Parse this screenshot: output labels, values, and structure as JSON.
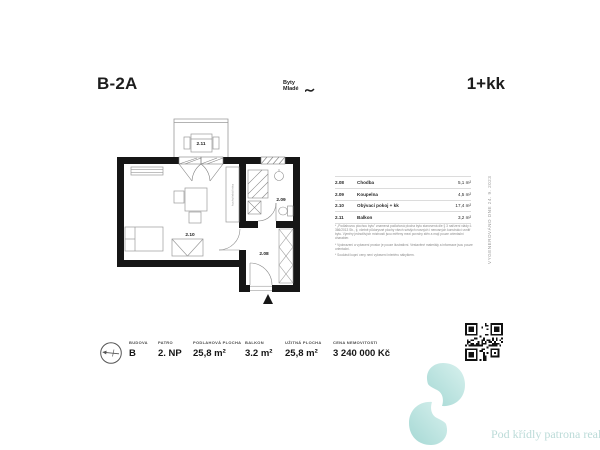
{
  "header": {
    "unit": "B-2A",
    "disposition": "1+kk",
    "brand_line1": "Byty",
    "brand_line2": "Mladé"
  },
  "plan": {
    "labels": {
      "balcony": "2.11",
      "living": "2.10",
      "bathroom": "2.09",
      "hall": "2.08"
    },
    "kitchen_label": "kuchyňská linka"
  },
  "legend": {
    "rows": [
      {
        "code": "2.08",
        "name": "Chodba",
        "area": "5,1 m²"
      },
      {
        "code": "2.09",
        "name": "Koupelna",
        "area": "4,5 m²"
      },
      {
        "code": "2.10",
        "name": "Obývací pokoj + kk",
        "area": "17,4 m²"
      },
      {
        "code": "2.11",
        "name": "Balkon",
        "area": "3,2 m²"
      }
    ],
    "notes": [
      "* „Podlahovou plochou bytu\" znamená podlahová plocha bytu stanovená dle § 3 nařízení vlády č. 366/2013 Sb., tj. včetně půdorysné plochy všech svislých nosných i nenosných konstrukcí uvnitř bytu. Výměry jednotlivých místností jsou měřeny mezi povrchy stěn a mají pouze orientační charakter.",
      "* Vyobrazení a vybavení prostor je pouze ilustrativní. Vestavěné materiály a informace jsou pouze orientační.",
      "* Součástí kupní ceny není vybavení interiéru nábytkem."
    ]
  },
  "side_note": "VYGENEROVÁNO DNE 24. 9. 2023",
  "summary": {
    "items": [
      {
        "label": "BUDOVA",
        "value": "B"
      },
      {
        "label": "PATRO",
        "value": "2. NP"
      },
      {
        "label": "PODLAHOVÁ PLOCHA",
        "value": "25,8 m²"
      },
      {
        "label": "BALKON",
        "value": "3.2 m²"
      },
      {
        "label": "UŽITNÁ PLOCHA",
        "value": "25,8 m²"
      },
      {
        "label": "CENA NEMOVITOSTI",
        "value": "3 240 000 Kč"
      }
    ]
  },
  "footer": {
    "watermark_text": "Pod křídly patrona reali"
  },
  "colors": {
    "wall": "#161616",
    "line": "#9a9a9a",
    "teal_light": "#d8f1ee",
    "teal_dark": "#a5d8d4",
    "watermark_text": "#bcdbd8"
  }
}
